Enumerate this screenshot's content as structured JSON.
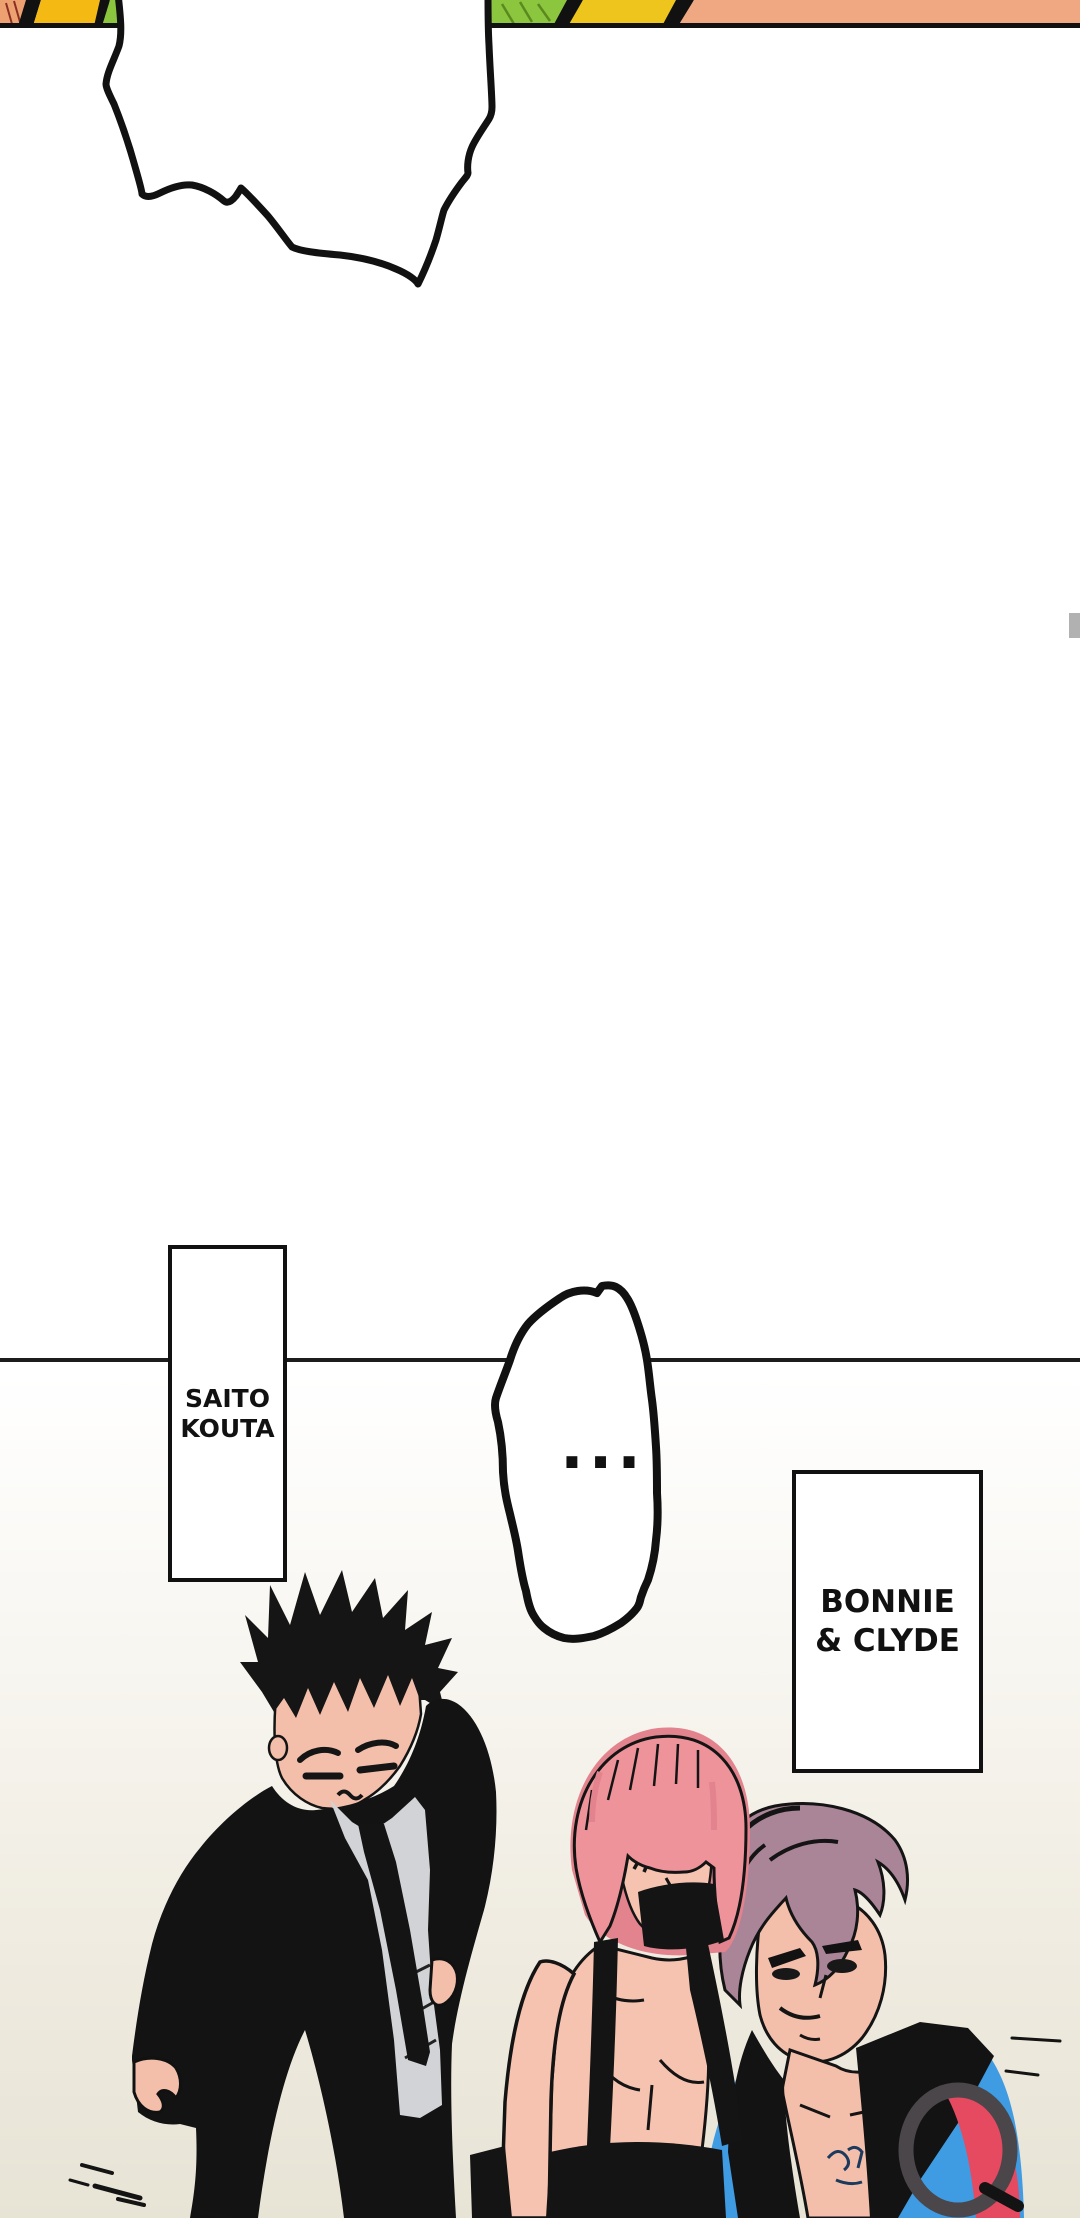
{
  "bubbles": {
    "large_bubble_text": "",
    "ellipsis_text": "..."
  },
  "name_boxes": {
    "saito": {
      "line1": "SAITO",
      "line2": "KOUTA"
    },
    "bonnie_clyde": {
      "line1": "BONNIE",
      "line2": "& CLYDE"
    }
  },
  "characters": {
    "saito": "man with spiky black hair wearing black suit and tie",
    "bonnie": "woman with pink bob haircut and black suspenders",
    "clyde": "man with mauve swept-back hair wearing blue jacket"
  },
  "colors": {
    "ink": "#141414",
    "panel_line": "#1c1c1c",
    "strip_orange_left": "#eda171",
    "strip_yellow_left": "#f4ba13",
    "strip_green": "#8cc63e",
    "strip_hatch_green": "#5a8a1e",
    "strip_hatch_red": "#8a2f22",
    "strip_yellow_right": "#eec51d",
    "strip_orange_right": "#f0a883",
    "skin": "#f3bfab",
    "skin_woman": "#f5c3b0",
    "shirt_gray": "#d2d3d6",
    "hair_black": "#151515",
    "hair_pink": "#ef939b",
    "hair_pink_dark": "#e2838d",
    "hair_mauve": "#aa8497",
    "jacket_blue": "#3f9be2",
    "jacket_red": "#e64a60",
    "ring_gray": "#4b464a",
    "lips_dark": "#23171c",
    "bubble_fill": "#ffffff",
    "scrollbar_thumb": "#b1b1b1",
    "background_bottom": "#e7e3d5"
  }
}
